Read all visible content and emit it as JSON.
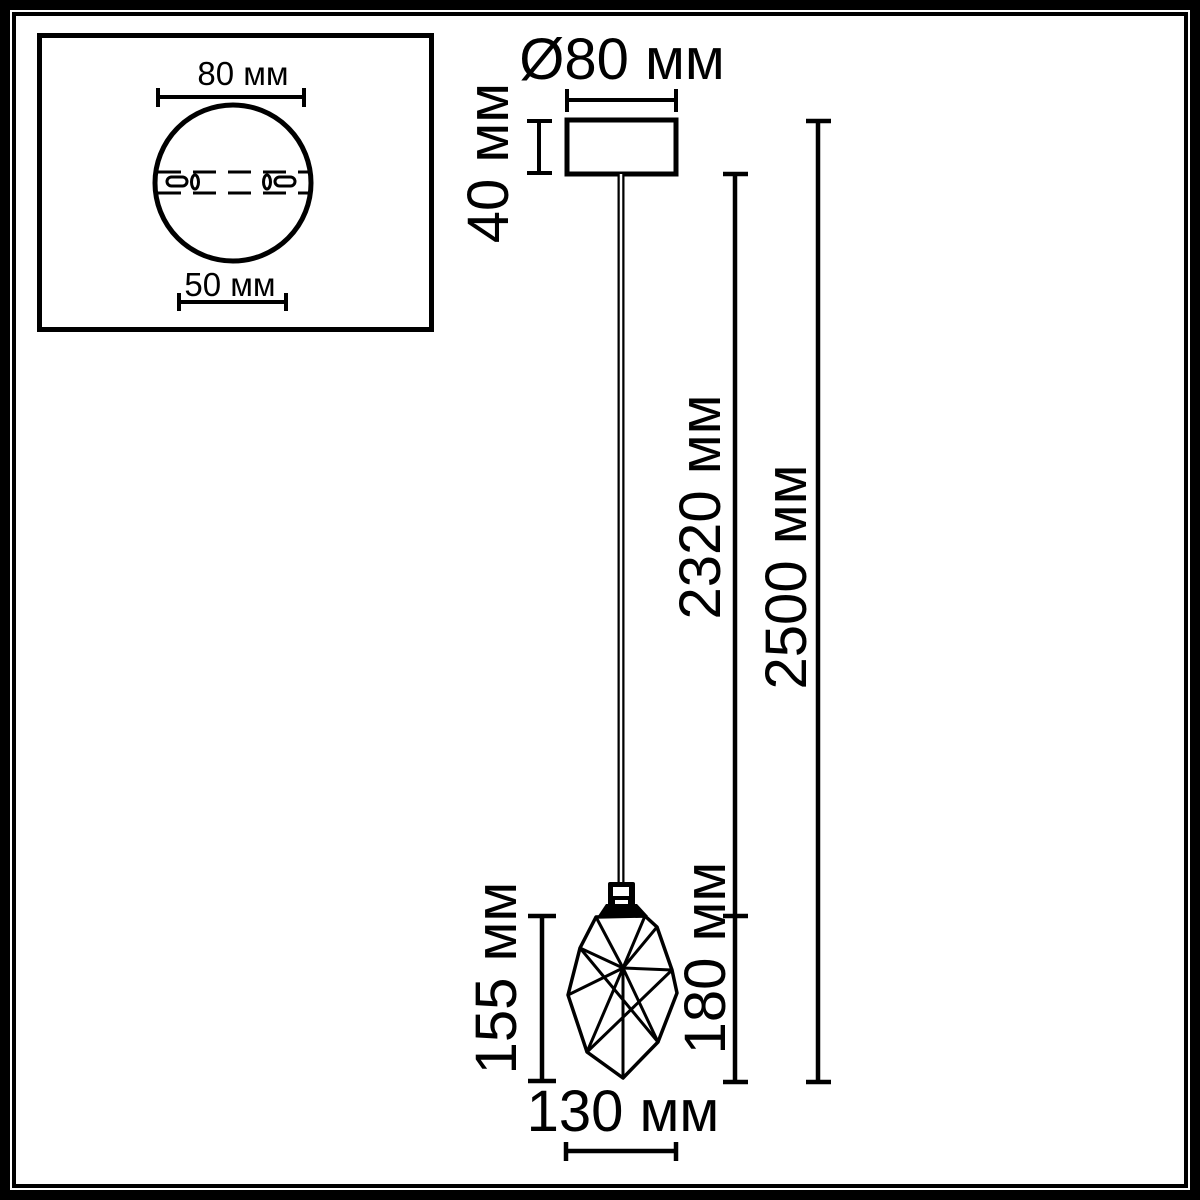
{
  "colors": {
    "line": "#000000",
    "background": "#ffffff"
  },
  "inset_top_view": {
    "plate_diameter_label": "80 мм",
    "mount_spacing_label": "50 мм"
  },
  "dimensions": {
    "canopy_diameter_label": "Ø80 мм",
    "canopy_height_label": "40 мм",
    "cord_length_label": "2320 мм",
    "total_height_label": "2500 мм",
    "shade_height_label": "155 мм",
    "shade_assembly_height_label": "180 мм",
    "shade_width_label": "130 мм"
  }
}
